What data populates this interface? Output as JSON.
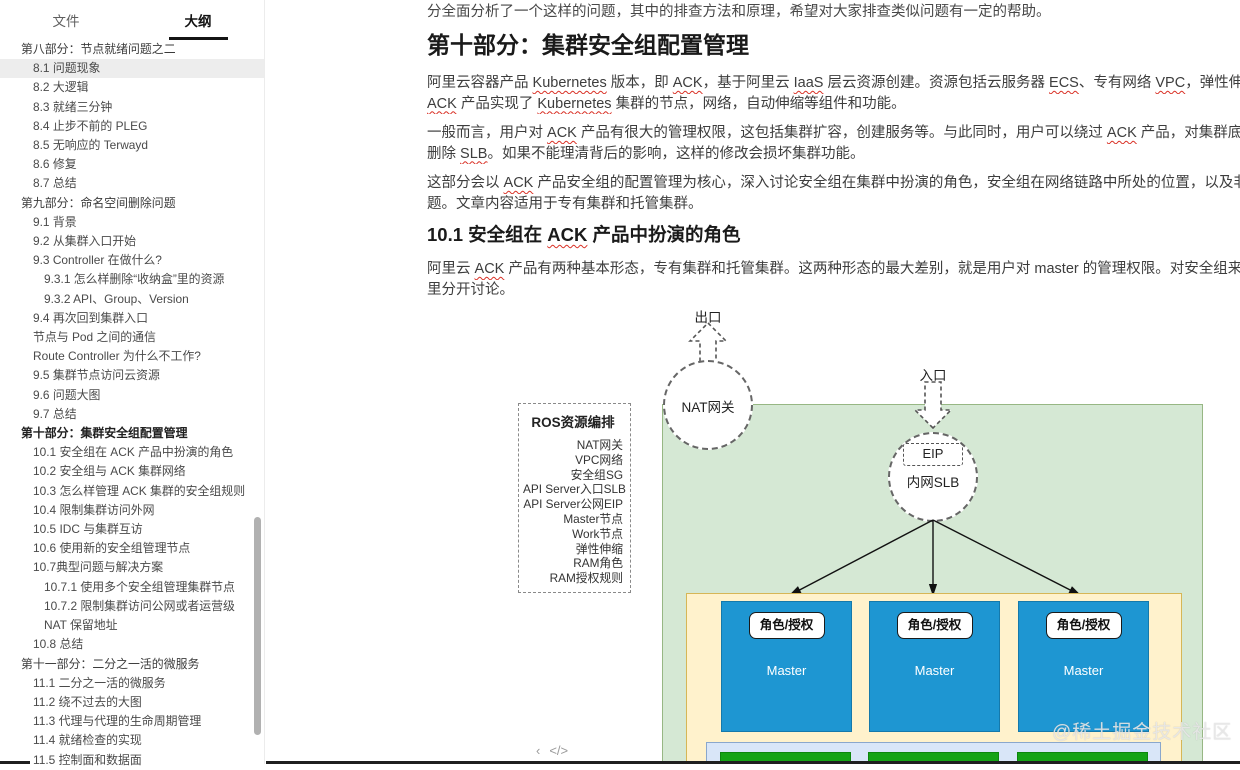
{
  "colors": {
    "wavy_red": "#d93025",
    "green_fill": "#d5e8d4",
    "green_border": "#97b784",
    "yellow_fill": "#fff2cc",
    "yellow_border": "#d6b656",
    "blue_fill": "#1e96d2",
    "blue_border": "#1579ab",
    "lightblue_fill": "#d9e6f8",
    "lightblue_border": "#8aa7cc",
    "bgreen_fill": "#15a315",
    "bgreen_border": "#0d860d"
  },
  "tabs": {
    "file": "文件",
    "outline": "大纲"
  },
  "sidebar": {
    "items": [
      {
        "label": "第八部分：节点就绪问题之二",
        "level": 0
      },
      {
        "label": "8.1 问题现象",
        "level": 1,
        "active": true
      },
      {
        "label": "8.2 大逻辑",
        "level": 1
      },
      {
        "label": "8.3 就绪三分钟",
        "level": 1
      },
      {
        "label": "8.4 止步不前的 PLEG",
        "level": 1
      },
      {
        "label": "8.5 无响应的 Terwayd",
        "level": 1
      },
      {
        "label": "8.6 修复",
        "level": 1
      },
      {
        "label": "8.7 总结",
        "level": 1
      },
      {
        "label": "第九部分：命名空间删除问题",
        "level": 0
      },
      {
        "label": "9.1 背景",
        "level": 1
      },
      {
        "label": "9.2 从集群入口开始",
        "level": 1
      },
      {
        "label": "9.3 Controller 在做什么?",
        "level": 1
      },
      {
        "label": "9.3.1 怎么样删除“收纳盒”里的资源",
        "level": 2
      },
      {
        "label": "9.3.2 API、Group、Version",
        "level": 2
      },
      {
        "label": "9.4 再次回到集群入口",
        "level": 1
      },
      {
        "label": "节点与 Pod 之间的通信",
        "level": 1
      },
      {
        "label": "Route Controller 为什么不工作?",
        "level": 1
      },
      {
        "label": "9.5 集群节点访问云资源",
        "level": 1
      },
      {
        "label": "9.6 问题大图",
        "level": 1
      },
      {
        "label": "9.7 总结",
        "level": 1
      },
      {
        "label": "第十部分：集群安全组配置管理",
        "level": 0,
        "bold": true
      },
      {
        "label": "10.1 安全组在 ACK 产品中扮演的角色",
        "level": 1
      },
      {
        "label": "10.2 安全组与 ACK 集群网络",
        "level": 1
      },
      {
        "label": "10.3 怎么样管理 ACK 集群的安全组规则",
        "level": 1
      },
      {
        "label": "10.4 限制集群访问外网",
        "level": 1
      },
      {
        "label": "10.5 IDC 与集群互访",
        "level": 1
      },
      {
        "label": "10.6 使用新的安全组管理节点",
        "level": 1
      },
      {
        "label": "10.7典型问题与解决方案",
        "level": 1
      },
      {
        "label": "10.7.1 使用多个安全组管理集群节点",
        "level": 2
      },
      {
        "label": "10.7.2 限制集群访问公网或者运营级 NAT 保留地址",
        "level": 2
      },
      {
        "label": "10.8 总结",
        "level": 1
      },
      {
        "label": "第十一部分：二分之一活的微服务",
        "level": 0
      },
      {
        "label": "11.1 二分之一活的微服务",
        "level": 1
      },
      {
        "label": "11.2 绕不过去的大图",
        "level": 1
      },
      {
        "label": "11.3 代理与代理的生命周期管理",
        "level": 1
      },
      {
        "label": "11.4 就绪检查的实现",
        "level": 1
      },
      {
        "label": "11.5 控制面和数据面",
        "level": 1
      }
    ]
  },
  "footer": {
    "collapse_icon": "‹",
    "code_icon": "</>"
  },
  "content": {
    "intro_line": "分全面分析了一个这样的问题，其中的排查方法和原理，希望对大家排查类似问题有一定的帮助。",
    "h1": "第十部分：集群安全组配置管理",
    "paragraphs_top": [
      {
        "lines": [
          [
            {
              "t": "阿里云容器产品 "
            },
            {
              "t": "Kubernetes",
              "w": true
            },
            {
              "t": " 版本，即 "
            },
            {
              "t": "ACK",
              "w": true
            },
            {
              "t": "，基于阿里云 "
            },
            {
              "t": "IaaS",
              "w": true
            },
            {
              "t": " 层云资源创建。资源包括云服务器 "
            },
            {
              "t": "ECS",
              "w": true
            },
            {
              "t": "、专有网络 "
            },
            {
              "t": "VPC",
              "w": true
            },
            {
              "t": "，弹性伸缩 "
            },
            {
              "t": "ESS",
              "w": true
            },
            {
              "t": " 等。以这些资源为"
            }
          ],
          [
            {
              "t": "ACK",
              "w": true
            },
            {
              "t": " 产品实现了 "
            },
            {
              "t": "Kubernetes",
              "w": true
            },
            {
              "t": " 集群的节点，网络，自动伸缩等组件和功能。"
            }
          ]
        ]
      },
      {
        "lines": [
          [
            {
              "t": "一般而言，用户对 "
            },
            {
              "t": "ACK",
              "w": true
            },
            {
              "t": " 产品有很大的管理权限，这包括集群扩容，创建服务等。与此同时，用户可以绕过 "
            },
            {
              "t": "ACK",
              "w": true
            },
            {
              "t": " 产品，对集群底层云资源进行修改。如果"
            }
          ],
          [
            {
              "t": "删除 "
            },
            {
              "t": "SLB",
              "w": true
            },
            {
              "t": "。如果不能理清背后的影响，这样的修改会损坏集群功能。"
            }
          ]
        ]
      },
      {
        "lines": [
          [
            {
              "t": "这部分会以 "
            },
            {
              "t": "ACK",
              "w": true
            },
            {
              "t": " 产品安全组的配置管理为核心，深入讨论安全组在集群中扮演的角色，安全组在网络链路中所处的位置，以及非法修改安全组会产生的问"
            }
          ],
          [
            {
              "t": "题。文章内容适用于专有集群和托管集群。"
            }
          ]
        ]
      }
    ],
    "h2_segments": [
      {
        "t": "10.1 安全组在 "
      },
      {
        "t": "ACK",
        "w": true
      },
      {
        "t": " 产品中扮演的角色"
      }
    ],
    "paragraphs_bottom": [
      {
        "lines": [
          [
            {
              "t": "阿里云 "
            },
            {
              "t": "ACK",
              "w": true
            },
            {
              "t": " 产品有两种基本形态，专有集群和托管集群。这两种形态的最大差别，就是用户对 master 的管理权限。对安全组来说，两种形态的集群略有"
            }
          ],
          [
            {
              "t": "里分开讨论。"
            }
          ]
        ]
      }
    ]
  },
  "diagram": {
    "exit_label": "出口",
    "entry_label": "入口",
    "nat_label": "NAT网关",
    "eip_label": "EIP",
    "slb_label": "内网SLB",
    "ros": {
      "title": "ROS资源编排",
      "items": [
        "NAT网关",
        "VPC网络",
        "安全组SG",
        "API Server入口SLB",
        "API Server公网EIP",
        "Master节点",
        "Work节点",
        "弹性伸缩",
        "RAM角色",
        "RAM授权规则"
      ]
    },
    "master_boxes": [
      {
        "tag": "角色/授权",
        "name": "Master"
      },
      {
        "tag": "角色/授权",
        "name": "Master"
      },
      {
        "tag": "角色/授权",
        "name": "Master"
      }
    ]
  },
  "watermark": "@稀土掘金技术社区"
}
